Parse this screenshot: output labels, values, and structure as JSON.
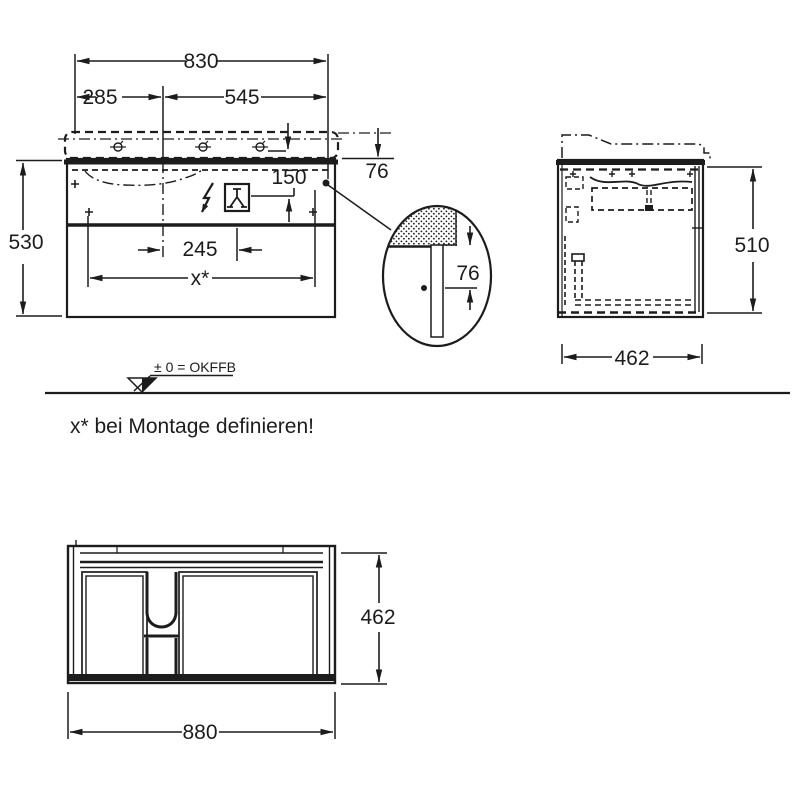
{
  "front_view": {
    "dim_total_width": "830",
    "dim_left_spacing": "285",
    "dim_right_spacing": "545",
    "dim_basin_height": "76",
    "dim_connection_height": "150",
    "dim_cabinet_height": "530",
    "dim_inner_spacing": "245",
    "dim_fixing_span": "x*"
  },
  "detail": {
    "dim_rail_offset": "76"
  },
  "side_view": {
    "dim_height": "510",
    "dim_depth": "462"
  },
  "plan_view": {
    "dim_depth": "462",
    "dim_width": "880"
  },
  "datum": {
    "label": "± 0 = OKFFB"
  },
  "note": {
    "text": "x* bei Montage definieren!"
  },
  "symbols": {
    "electrical": "lightning-bolt-icon",
    "water": "tap-icon",
    "fixing": "screw-circle-icon",
    "datum": "datum-triangle-icon"
  },
  "colors": {
    "line": "#1c1c1c",
    "background": "#ffffff"
  }
}
